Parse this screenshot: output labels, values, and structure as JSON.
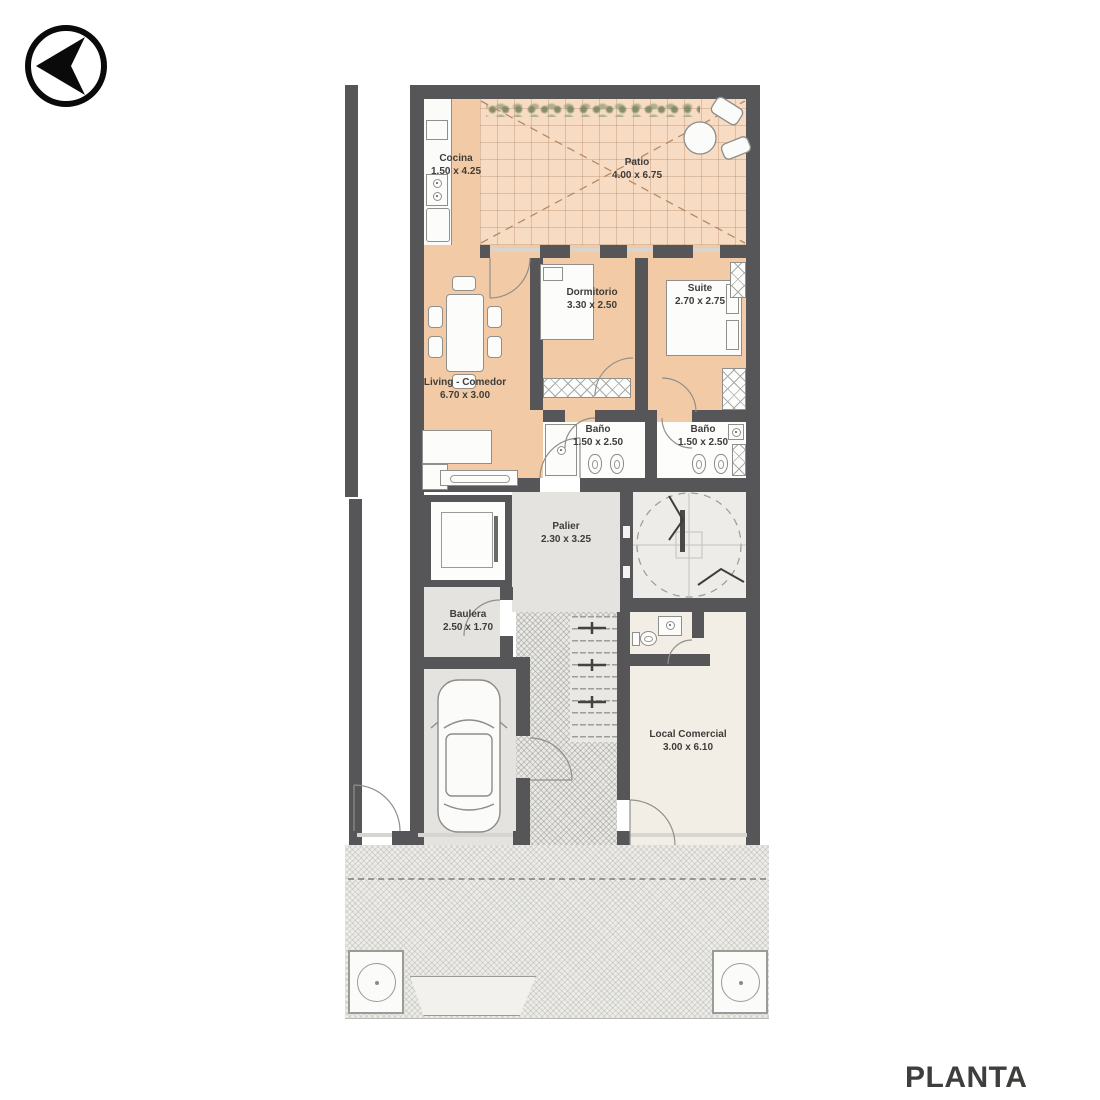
{
  "page": {
    "title": "PLANTA BAJA"
  },
  "rooms": [
    {
      "name": "Cocina",
      "dims": "1.50 x 4.25"
    },
    {
      "name": "Patio",
      "dims": "4.00 x 6.75"
    },
    {
      "name": "Dormitorio",
      "dims": "3.30 x 2.50"
    },
    {
      "name": "Suite",
      "dims": "2.70 x 2.75"
    },
    {
      "name": "Living - Comedor",
      "dims": "6.70 x 3.00"
    },
    {
      "name": "Baño",
      "dims": "1.50 x 2.50"
    },
    {
      "name": "Baño",
      "dims": "1.50 x 2.50"
    },
    {
      "name": "Palier",
      "dims": "2.30 x 3.25"
    },
    {
      "name": "Baulera",
      "dims": "2.50 x 1.70"
    },
    {
      "name": "Local Comercial",
      "dims": "3.00 x 6.10"
    }
  ],
  "colors": {
    "floor_main": "#f2cba6",
    "floor_patio": "#f7dcc3",
    "floor_gray": "#e4e3df",
    "floor_cream": "#f3eee5",
    "wall": "#565658",
    "text": "#3e3d3b"
  }
}
